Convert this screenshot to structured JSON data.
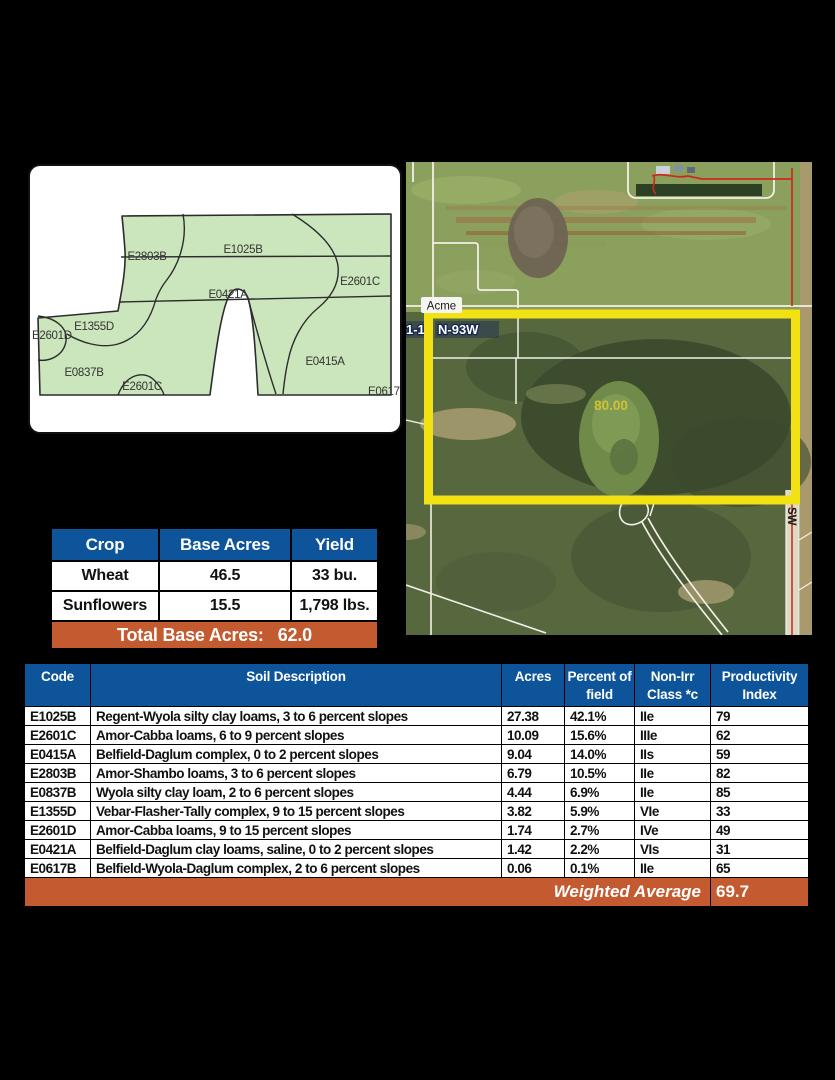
{
  "colors": {
    "header_blue": "#0e549b",
    "accent_orange": "#c45a30",
    "map_green": "#cbe6bc",
    "highlight_yellow": "#f2e113"
  },
  "soil_map": {
    "labels": [
      {
        "text": "E2803B"
      },
      {
        "text": "E1025B"
      },
      {
        "text": "E2601C"
      },
      {
        "text": "E0421A"
      },
      {
        "text": "E1355D"
      },
      {
        "text": "E2601D"
      },
      {
        "text": "E0837B"
      },
      {
        "text": "E2601C"
      },
      {
        "text": "E0415A"
      },
      {
        "text": "E0617B"
      }
    ]
  },
  "aerial": {
    "place_label": "Acme",
    "township_left": "1-13",
    "township_right": "N-93W",
    "tract_acres_label": "80.00",
    "road_label": "SW"
  },
  "crop_table": {
    "headers": [
      "Crop",
      "Base Acres",
      "Yield"
    ],
    "rows": [
      [
        "Wheat",
        "46.5",
        "33 bu."
      ],
      [
        "Sunflowers",
        "15.5",
        "1,798 lbs."
      ]
    ],
    "total_label": "Total Base Acres:",
    "total_value": "62.0"
  },
  "soil_table": {
    "headers": [
      "Code",
      "Soil Description",
      "Acres",
      "Percent of field",
      "Non-Irr Class *c",
      "Productivity Index"
    ],
    "rows": [
      [
        "E1025B",
        "Regent-Wyola silty clay loams, 3 to 6 percent slopes",
        "27.38",
        "42.1%",
        "IIe",
        "79"
      ],
      [
        "E2601C",
        "Amor-Cabba loams, 6 to 9 percent slopes",
        "10.09",
        "15.6%",
        "IIIe",
        "62"
      ],
      [
        "E0415A",
        "Belfield-Daglum complex, 0 to 2 percent slopes",
        "9.04",
        "14.0%",
        "IIs",
        "59"
      ],
      [
        "E2803B",
        "Amor-Shambo loams, 3 to 6 percent slopes",
        "6.79",
        "10.5%",
        "IIe",
        "82"
      ],
      [
        "E0837B",
        "Wyola silty clay loam, 2 to 6 percent slopes",
        "4.44",
        "6.9%",
        "IIe",
        "85"
      ],
      [
        "E1355D",
        "Vebar-Flasher-Tally complex, 9 to 15 percent slopes",
        "3.82",
        "5.9%",
        "VIe",
        "33"
      ],
      [
        "E2601D",
        "Amor-Cabba loams, 9 to 15 percent slopes",
        "1.74",
        "2.7%",
        "IVe",
        "49"
      ],
      [
        "E0421A",
        "Belfield-Daglum clay loams, saline, 0 to 2 percent slopes",
        "1.42",
        "2.2%",
        "VIs",
        "31"
      ],
      [
        "E0617B",
        "Belfield-Wyola-Daglum complex, 2 to 6 percent slopes",
        "0.06",
        "0.1%",
        "IIe",
        "65"
      ]
    ],
    "footer_label": "Weighted Average",
    "footer_value": "69.7"
  }
}
